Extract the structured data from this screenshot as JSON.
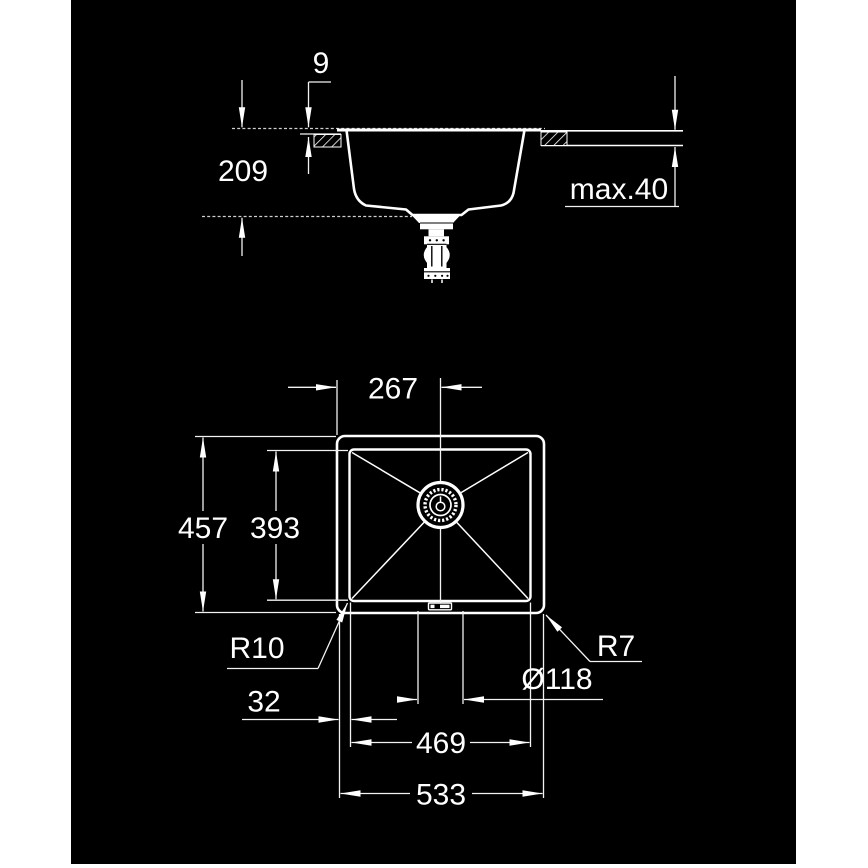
{
  "title": "Undermount kitchen sink dimensional drawing",
  "colors": {
    "page_background": "#ffffff",
    "drawing_background": "#000000",
    "line": "#ffffff"
  },
  "views": {
    "side": {
      "labels": {
        "rim_height": "9",
        "bowl_depth": "209",
        "counter_thickness_max": "max.40"
      }
    },
    "top": {
      "labels": {
        "drain_center_from_left": "267",
        "outer_depth": "457",
        "bowl_inner_depth": "393",
        "bowl_corner_radius": "R10",
        "outer_corner_radius": "R7",
        "drain_diameter": "Ø118",
        "rim_to_bowl_offset": "32",
        "bowl_inner_width": "469",
        "outer_width": "533"
      }
    }
  }
}
